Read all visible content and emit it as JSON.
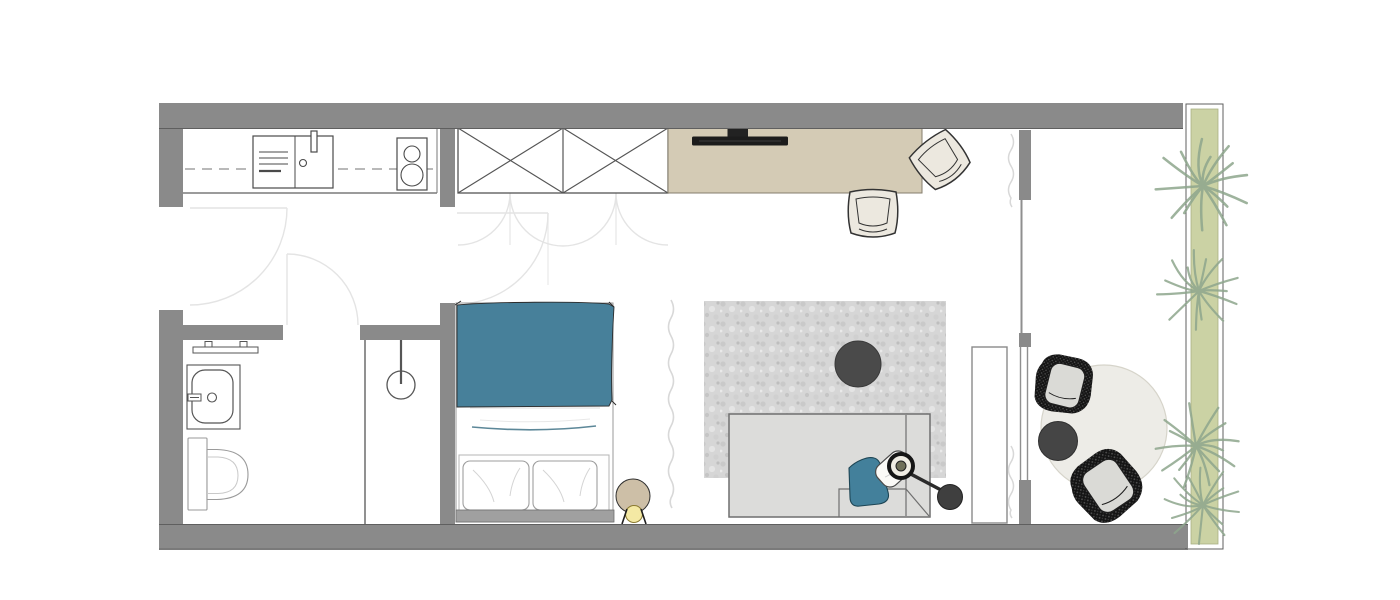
{
  "plan": {
    "kind": "studio-apartment-floor-plan",
    "visible_text": [],
    "colors": {
      "wall_gray": "#8a8a8a",
      "floor_white": "#ffffff",
      "bed_blanket_teal": "#47809a",
      "teal_pillow": "#43809b",
      "desk_beige": "#d4cbb5",
      "tv_black": "#1c1c1c",
      "area_rug_gray": "#d6d6d6",
      "sofa_gray": "#dcdcda",
      "coffee_table_gray": "#4a4a4a",
      "round_rug_cream": "#edece7",
      "lounge_chair_black": "#141414",
      "cushion_gray": "#dadad6",
      "desk_chair_cream": "#ece8df",
      "planter_green": "#cbd2a4",
      "plant_green": "#8ea68d",
      "lamp_shade_beige": "#cdbfa7",
      "lamp_glow_yellow": "#f4e9a4",
      "headboard_gray": "#a0a0a0",
      "door_swing_gray": "#e4e4e4",
      "line_dark": "#4a4a4a"
    },
    "rooms": [
      {
        "name": "entry-kitchen"
      },
      {
        "name": "bathroom"
      },
      {
        "name": "living-sleeping-area"
      },
      {
        "name": "balcony-lounge"
      }
    ],
    "symbols": [
      {
        "name": "kitchen-counter"
      },
      {
        "name": "kitchen-sink"
      },
      {
        "name": "cooktop"
      },
      {
        "name": "bathroom-shelf"
      },
      {
        "name": "bathroom-sink"
      },
      {
        "name": "toilet"
      },
      {
        "name": "shower-head"
      },
      {
        "name": "shower-partition"
      },
      {
        "name": "wardrobe"
      },
      {
        "name": "desk"
      },
      {
        "name": "tv"
      },
      {
        "name": "desk-chair"
      },
      {
        "name": "bed"
      },
      {
        "name": "pillow"
      },
      {
        "name": "bedside-lamp"
      },
      {
        "name": "curtain"
      },
      {
        "name": "area-rug"
      },
      {
        "name": "coffee-table"
      },
      {
        "name": "sofa"
      },
      {
        "name": "throw-pillow"
      },
      {
        "name": "arc-floor-lamp"
      },
      {
        "name": "console"
      },
      {
        "name": "glass-partition"
      },
      {
        "name": "round-rug"
      },
      {
        "name": "side-table"
      },
      {
        "name": "lounge-chair"
      },
      {
        "name": "planter"
      },
      {
        "name": "plant"
      },
      {
        "name": "door-swing"
      }
    ]
  }
}
